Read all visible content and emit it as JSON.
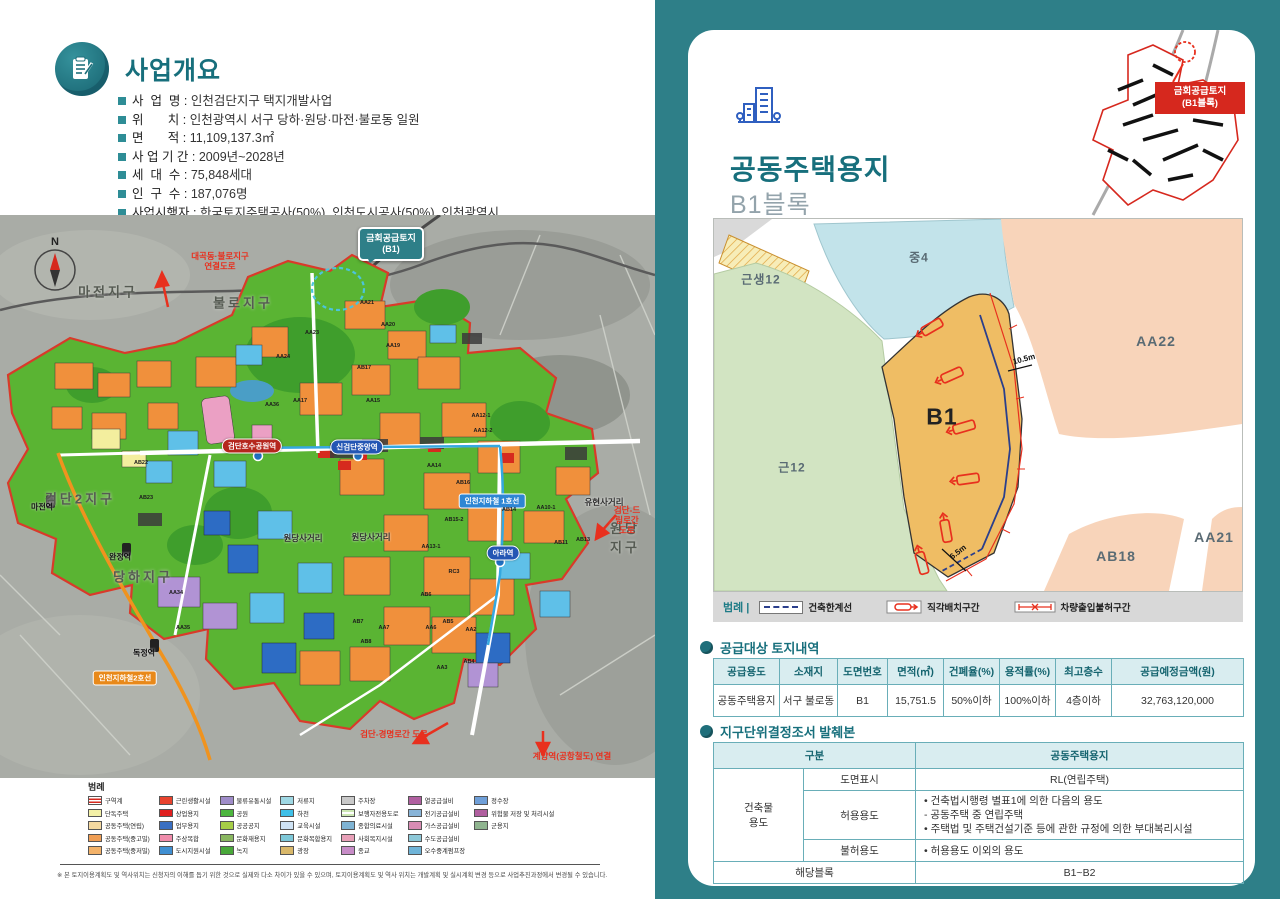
{
  "left": {
    "overview": {
      "title": "사업개요",
      "items": [
        {
          "label": "사  업  명",
          "value": "인천검단지구 택지개발사업"
        },
        {
          "label": "위       치",
          "value": "인천광역시 서구 당하·원당·마전·불로동 일원"
        },
        {
          "label": "면       적",
          "value": "11,109,137.3㎡"
        },
        {
          "label": "사 업 기 간",
          "value": "2009년~2028년"
        },
        {
          "label": "세  대  수",
          "value": "75,848세대"
        },
        {
          "label": "인  구  수",
          "value": "187,076명"
        },
        {
          "label": "사업시행자",
          "value": "한국토지주택공사(50%), 인천도시공사(50%), 인천광역시"
        }
      ]
    },
    "map": {
      "callout": "금회공급토지\n(B1)",
      "labels": [
        {
          "t": "N",
          "x": 55,
          "y": 27,
          "c": "compass"
        },
        {
          "t": "마전지구",
          "x": 108,
          "y": 76,
          "c": "district"
        },
        {
          "t": "불로지구",
          "x": 243,
          "y": 87,
          "c": "district"
        },
        {
          "t": "검단2지구",
          "x": 80,
          "y": 283,
          "c": "district"
        },
        {
          "t": "당하지구",
          "x": 143,
          "y": 361,
          "c": "district"
        },
        {
          "t": "원당지구",
          "x": 625,
          "y": 322,
          "c": "district"
        },
        {
          "t": "원당사거리",
          "x": 371,
          "y": 322,
          "c": "cross"
        },
        {
          "t": "원당사거리",
          "x": 303,
          "y": 323,
          "c": "cross"
        },
        {
          "t": "유현사거리",
          "x": 604,
          "y": 287,
          "c": "cross"
        },
        {
          "t": "검단호수공원역",
          "x": 252,
          "y": 231,
          "c": "stationRed"
        },
        {
          "t": "신검단중앙역",
          "x": 357,
          "y": 232,
          "c": "stationBlue"
        },
        {
          "t": "아라역",
          "x": 503,
          "y": 338,
          "c": "stationBlue"
        },
        {
          "t": "인천지하철 1호선",
          "x": 492,
          "y": 286,
          "c": "line1"
        },
        {
          "t": "인천지하철2호선",
          "x": 125,
          "y": 463,
          "c": "line2"
        },
        {
          "t": "마전역",
          "x": 42,
          "y": 292,
          "c": "stationSm"
        },
        {
          "t": "완정역",
          "x": 120,
          "y": 342,
          "c": "stationSm"
        },
        {
          "t": "독정역",
          "x": 144,
          "y": 438,
          "c": "stationSm"
        },
        {
          "t": "대곡동·불로지구\n연결도로",
          "x": 220,
          "y": 46,
          "c": "roadRed"
        },
        {
          "t": "검단-드림로간\n도로",
          "x": 627,
          "y": 305,
          "c": "roadRed"
        },
        {
          "t": "검단-경명로간 도로",
          "x": 394,
          "y": 519,
          "c": "roadRed"
        },
        {
          "t": "계양역(공항철도) 연결",
          "x": 572,
          "y": 541,
          "c": "roadRed"
        },
        {
          "t": "AA23",
          "x": 312,
          "y": 118,
          "c": "parcel"
        },
        {
          "t": "AA24",
          "x": 283,
          "y": 142,
          "c": "parcel"
        },
        {
          "t": "AA17",
          "x": 300,
          "y": 186,
          "c": "parcel"
        },
        {
          "t": "AA36",
          "x": 272,
          "y": 190,
          "c": "parcel"
        },
        {
          "t": "AA21",
          "x": 367,
          "y": 88,
          "c": "parcel"
        },
        {
          "t": "AA20",
          "x": 388,
          "y": 110,
          "c": "parcel"
        },
        {
          "t": "AA19",
          "x": 393,
          "y": 131,
          "c": "parcel"
        },
        {
          "t": "AB17",
          "x": 364,
          "y": 153,
          "c": "parcel"
        },
        {
          "t": "AA15",
          "x": 373,
          "y": 186,
          "c": "parcel"
        },
        {
          "t": "AA12-1",
          "x": 481,
          "y": 201,
          "c": "parcel"
        },
        {
          "t": "AA12-2",
          "x": 483,
          "y": 216,
          "c": "parcel"
        },
        {
          "t": "AA14",
          "x": 434,
          "y": 251,
          "c": "parcel"
        },
        {
          "t": "AB16",
          "x": 463,
          "y": 268,
          "c": "parcel"
        },
        {
          "t": "AB15-2",
          "x": 454,
          "y": 305,
          "c": "parcel"
        },
        {
          "t": "AB14",
          "x": 509,
          "y": 295,
          "c": "parcel"
        },
        {
          "t": "AA10-1",
          "x": 546,
          "y": 293,
          "c": "parcel"
        },
        {
          "t": "AB13",
          "x": 583,
          "y": 325,
          "c": "parcel"
        },
        {
          "t": "AB11",
          "x": 561,
          "y": 328,
          "c": "parcel"
        },
        {
          "t": "AA13-1",
          "x": 431,
          "y": 332,
          "c": "parcel"
        },
        {
          "t": "RC3",
          "x": 454,
          "y": 357,
          "c": "parcel"
        },
        {
          "t": "AB6",
          "x": 426,
          "y": 380,
          "c": "parcel"
        },
        {
          "t": "AB7",
          "x": 358,
          "y": 407,
          "c": "parcel"
        },
        {
          "t": "AA7",
          "x": 384,
          "y": 413,
          "c": "parcel"
        },
        {
          "t": "AA6",
          "x": 431,
          "y": 413,
          "c": "parcel"
        },
        {
          "t": "AB5",
          "x": 448,
          "y": 407,
          "c": "parcel"
        },
        {
          "t": "AA2",
          "x": 471,
          "y": 415,
          "c": "parcel"
        },
        {
          "t": "AB8",
          "x": 366,
          "y": 427,
          "c": "parcel"
        },
        {
          "t": "AB4",
          "x": 469,
          "y": 447,
          "c": "parcel"
        },
        {
          "t": "AA3",
          "x": 442,
          "y": 453,
          "c": "parcel"
        },
        {
          "t": "AA34",
          "x": 176,
          "y": 378,
          "c": "parcel"
        },
        {
          "t": "AA35",
          "x": 183,
          "y": 413,
          "c": "parcel"
        },
        {
          "t": "AB22",
          "x": 141,
          "y": 248,
          "c": "parcel"
        },
        {
          "t": "AB23",
          "x": 146,
          "y": 283,
          "c": "parcel"
        }
      ]
    },
    "legend": {
      "title": "범례",
      "columns": [
        {
          "items": [
            {
              "label": "구역계",
              "color": "boundary"
            },
            {
              "label": "단독주택",
              "color": "#f3f0a6"
            },
            {
              "label": "공동주택(연립)",
              "color": "#f5d9a0"
            },
            {
              "label": "공동주택(중고밀)",
              "color": "#f09e54"
            },
            {
              "label": "공동주택(중저밀)",
              "color": "#f3b269"
            }
          ]
        },
        {
          "items": [
            {
              "label": "근린생활시설",
              "color": "#e8432e"
            },
            {
              "label": "상업용지",
              "color": "#e01f1f"
            },
            {
              "label": "업무용지",
              "color": "#3a6fc2"
            },
            {
              "label": "주상복합",
              "color": "#f08cab"
            },
            {
              "label": "도시지원시설",
              "color": "#3f8fd2"
            }
          ]
        },
        {
          "items": [
            {
              "label": "물류유통시설",
              "color": "#9f8cc9"
            },
            {
              "label": "공원",
              "color": "#4cb63e"
            },
            {
              "label": "공공공지",
              "color": "#a6ce46"
            },
            {
              "label": "문화재용지",
              "color": "#8ab761"
            },
            {
              "label": "녹지",
              "color": "#49a83a"
            }
          ]
        },
        {
          "items": [
            {
              "label": "저류지",
              "color": "#9fd8e4"
            },
            {
              "label": "하천",
              "color": "#3fc0e8"
            },
            {
              "label": "교육시설",
              "color": "#cfe3f5"
            },
            {
              "label": "문화복합용지",
              "color": "#7ec8d8"
            },
            {
              "label": "광장",
              "color": "#d9b86a"
            }
          ]
        },
        {
          "items": [
            {
              "label": "주차장",
              "color": "#c9c9c9"
            },
            {
              "label": "보행자전용도로",
              "color": "stripe"
            },
            {
              "label": "종합의료시설",
              "color": "#7fb4d4"
            },
            {
              "label": "사회복지시설",
              "color": "#e8a0b8"
            },
            {
              "label": "종교",
              "color": "#c78cc7"
            }
          ]
        },
        {
          "items": [
            {
              "label": "열공급설비",
              "color": "#b05fa0"
            },
            {
              "label": "전기공급설비",
              "color": "#88b4d8"
            },
            {
              "label": "가스공급설비",
              "color": "#d88cb4"
            },
            {
              "label": "수도공급설비",
              "color": "#8cc8d8"
            },
            {
              "label": "오수중계펌프장",
              "color": "#6fb4d8"
            }
          ]
        },
        {
          "items": [
            {
              "label": "정수장",
              "color": "#6f9fd8"
            },
            {
              "label": "위험물 저장 및 처리시설",
              "color": "#b05f9f"
            },
            {
              "label": "군용지",
              "color": "#8fb48f"
            }
          ]
        }
      ]
    },
    "footnote": "※ 본 토지이용계획도 및 역사위치는 신청자의 이해를 돕기 위한 것으로 실제와 다소 차이가 있을 수 있으며, 토지이용계획도 및 역사 위치는 개발계획 및 실시계획 변경 등으로 사업추진과정에서 변경될 수 있습니다."
  },
  "right": {
    "title": "공동주택용지",
    "subtitle": "B1블록",
    "minimap_tag": "금회공급토지\n(B1블록)",
    "site_plan": {
      "areas": {
        "geunsaeng12": "근생12",
        "jung4": "중4",
        "aa22": "AA22",
        "geun12": "근12",
        "b1": "B1",
        "ab18": "AB18",
        "aa21": "AA21"
      },
      "dims": [
        "10.5m",
        "6.5m"
      ],
      "legend": {
        "title": "범례 |",
        "items": [
          "건축한계선",
          "직각배치구간",
          "차량출입불허구간"
        ]
      }
    },
    "supply_table": {
      "title": "공급대상 토지내역",
      "headers": [
        "공급용도",
        "소재지",
        "도면번호",
        "면적(㎡)",
        "건폐율(%)",
        "용적률(%)",
        "최고층수",
        "공급예정금액(원)"
      ],
      "row": [
        "공동주택용지",
        "서구 불로동",
        "B1",
        "15,751.5",
        "50%이하",
        "100%이하",
        "4층이하",
        "32,763,120,000"
      ]
    },
    "district_table": {
      "title": "지구단위결정조서 발췌본",
      "header_left": "구분",
      "header_right": "공동주택용지",
      "group_label": "건축물\n용도",
      "rows": [
        {
          "label": "도면표시",
          "value": "RL(연립주택)",
          "align": "center"
        },
        {
          "label": "허용용도",
          "value": "• 건축법시행령 별표1에 의한 다음의 용도\n   - 공동주택 중 연립주택\n• 주택법 및 주택건설기준 등에 관한 규정에 의한 부대복리시설",
          "align": "left"
        },
        {
          "label": "불허용도",
          "value": "• 허용용도 이외의 용도",
          "align": "left"
        }
      ],
      "footer_label": "해당블록",
      "footer_value": "B1~B2"
    }
  }
}
